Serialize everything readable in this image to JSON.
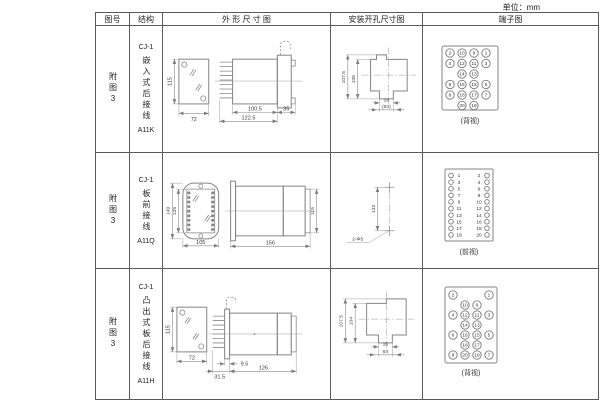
{
  "unit_label": "单位：mm",
  "headers": {
    "fig_no": "图号",
    "structure": "结构",
    "outline": "外 形 尺 寸 图",
    "mounting": "安装开孔尺寸图",
    "terminal": "端子图"
  },
  "rows": [
    {
      "fig_no": "附图3",
      "model": "CJ-1",
      "mount_type": "嵌入式后接线",
      "code": "A11K",
      "outline": {
        "front_h": "115",
        "front_w": "72",
        "body_d": "100.5",
        "total_d": "122.5",
        "flange_d": "35"
      },
      "mounting": {
        "outer_h": "107.5",
        "inner_h": "105",
        "slot_w": "16",
        "bottom_w": "(64)"
      },
      "terminal_caption": "(背视)"
    },
    {
      "fig_no": "附图3",
      "model": "CJ-1",
      "mount_type": "板前接线",
      "code": "A11Q",
      "outline": {
        "outer_h": "149",
        "inner_h": "125",
        "front_w": "105",
        "body_d": "156",
        "side_h": "115"
      },
      "mounting": {
        "hole_pitch": "133",
        "holes": "2-Φ5"
      },
      "terminal_caption": "(前视)"
    },
    {
      "fig_no": "附图3",
      "model": "CJ-1",
      "mount_type": "凸出式板后接线",
      "code": "A11H",
      "outline": {
        "front_h": "115",
        "front_w": "72",
        "pin_d": "31.5",
        "flange_t": "9.5",
        "body_d": "126"
      },
      "mounting": {
        "outer_h": "107.5",
        "inner_h": "104",
        "slot_w": "16",
        "bottom_w": "64"
      },
      "terminal_caption": "(背视)"
    }
  ],
  "terminals": {
    "back1": [
      [
        "2",
        "10",
        "9",
        "1"
      ],
      [
        "4",
        "12",
        "11",
        "3"
      ],
      [
        "",
        "14",
        "13",
        ""
      ],
      [
        "6",
        "16",
        "15",
        "5"
      ],
      [
        "8",
        "18",
        "17",
        "7"
      ],
      [
        "",
        "20",
        "19",
        ""
      ]
    ],
    "front_left": [
      "1",
      "3",
      "5",
      "7",
      "9",
      "11",
      "13",
      "15",
      "17",
      "19"
    ],
    "front_right": [
      "2",
      "4",
      "6",
      "8",
      "10",
      "12",
      "14",
      "16",
      "18",
      "20"
    ],
    "back3": [
      [
        "2",
        "",
        "",
        "1"
      ],
      [
        "",
        "10",
        "9",
        ""
      ],
      [
        "4",
        "12",
        "11",
        "3"
      ],
      [
        "",
        "14",
        "13",
        ""
      ],
      [
        "6",
        "16",
        "15",
        "5"
      ],
      [
        "",
        "18",
        "17",
        ""
      ],
      [
        "8",
        "20",
        "19",
        "7"
      ]
    ]
  }
}
